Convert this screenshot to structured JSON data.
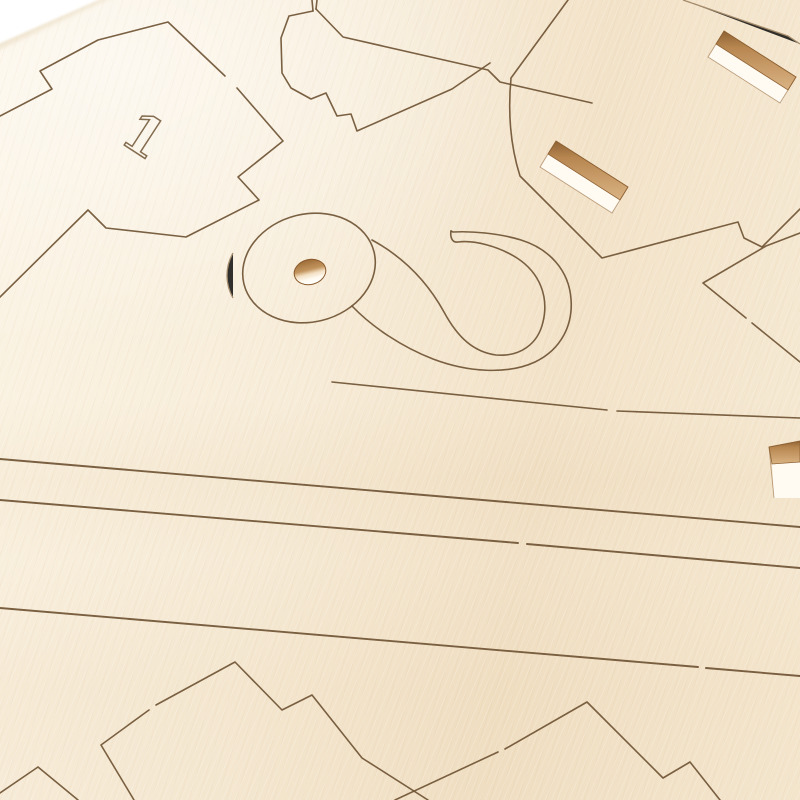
{
  "scene": {
    "title": "Close-up photo of a laser-cut plywood model-kit sheet",
    "sheet_number": "1"
  },
  "engraving": {
    "numeral": "1"
  },
  "parts": {
    "cross_part": "stepped cross outline engraved with numeral 1",
    "hook_part": "hook shaped piece with round head and drilled hole",
    "slotted_panel": "panel with two rectangular through slots",
    "strip_cuts": "four long shallow diagonal cut lines",
    "bottom_parts": "partially visible zigzag part outlines at bottom edge"
  },
  "colors": {
    "background_white": "#ffffff",
    "wood_light": "#fbf3e3",
    "wood_mid": "#f6ead4",
    "wood_warm": "#f2e2c8",
    "cut_line": "#6f5434",
    "cut_line_light": "#927654",
    "slot_wall_tan": "#b5824a",
    "slot_wall_dark": "#8a5c2d",
    "slot_through_white": "#fffaf2",
    "hole_rim": "#9d6c38"
  }
}
